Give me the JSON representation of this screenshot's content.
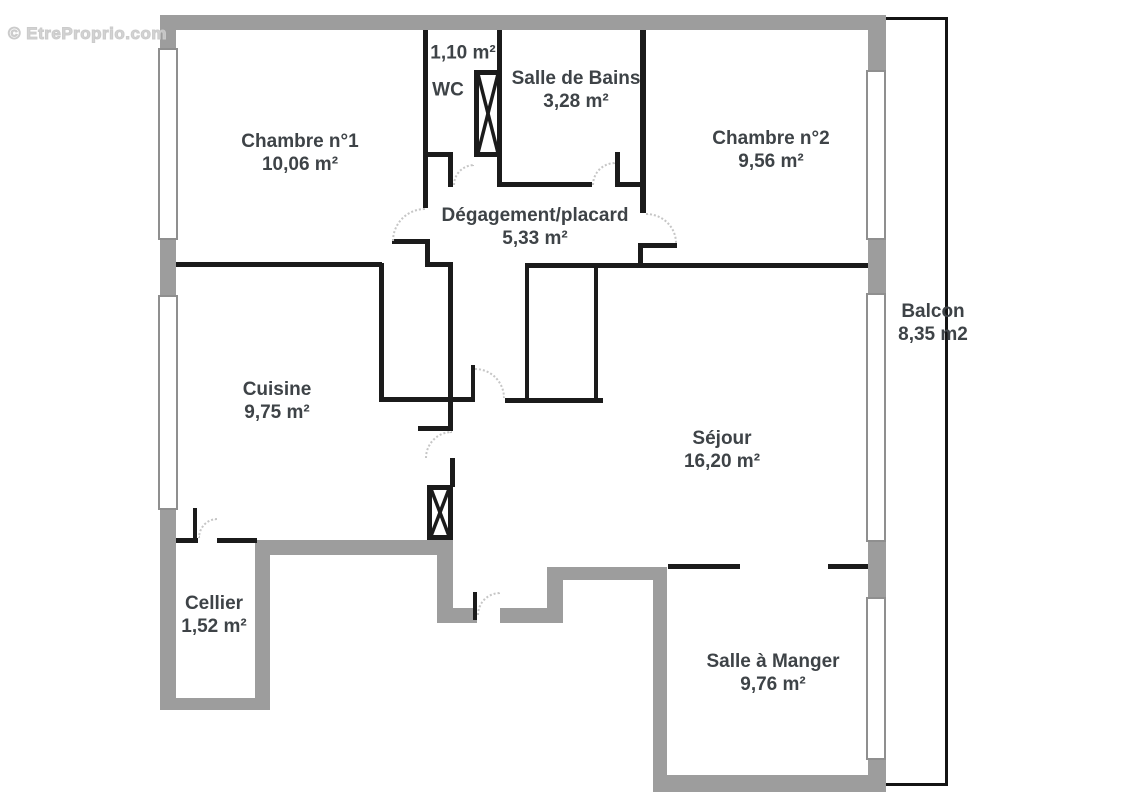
{
  "watermark": {
    "text": "© EtreProprio.com"
  },
  "floorplan": {
    "rooms": [
      {
        "id": "chambre-1",
        "name": "Chambre n°1",
        "area": "10,06 m²"
      },
      {
        "id": "wc",
        "name": "WC",
        "area": "1,10 m²"
      },
      {
        "id": "salle-de-bains",
        "name": "Salle de Bains",
        "area": "3,28 m²"
      },
      {
        "id": "chambre-2",
        "name": "Chambre n°2",
        "area": "9,56 m²"
      },
      {
        "id": "degagement",
        "name": "Dégagement/placard",
        "area": "5,33 m²"
      },
      {
        "id": "balcon",
        "name": "Balcon",
        "area": "8,35 m2"
      },
      {
        "id": "cuisine",
        "name": "Cuisine",
        "area": "9,75 m²"
      },
      {
        "id": "sejour",
        "name": "Séjour",
        "area": "16,20 m²"
      },
      {
        "id": "cellier",
        "name": "Cellier",
        "area": "1,52 m²"
      },
      {
        "id": "salle-a-manger",
        "name": "Salle à Manger",
        "area": "9,76 m²"
      }
    ],
    "colors": {
      "interior_wall": "#1b1b1b",
      "structural_wall": "#9d9d9d",
      "balcony_outline": "#141414",
      "label_text": "#3e4347",
      "door_arc": "#c6c6c6",
      "watermark": "#cbcbcb",
      "background": "#ffffff"
    }
  }
}
